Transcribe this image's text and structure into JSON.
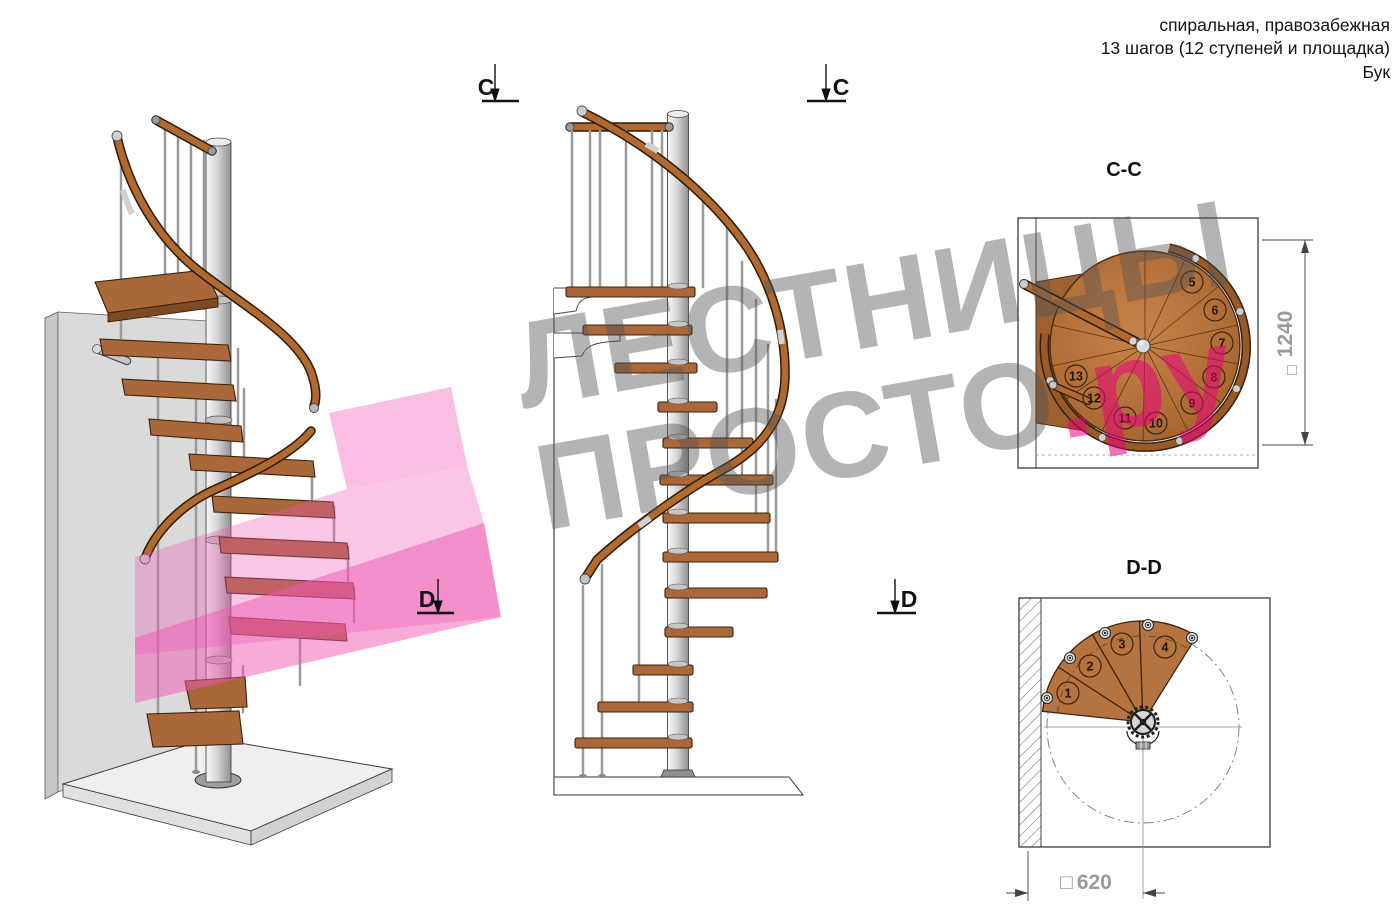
{
  "page": {
    "background": "#ffffff",
    "width": 1400,
    "height": 922
  },
  "header": {
    "line1": "спиральная, правозабежная",
    "line2": "13 шагов (12 ступеней и площадка)",
    "line3": "Бук"
  },
  "watermark": {
    "line1": "ЛЕСТНИЦЫ",
    "line2_gray": "ПРОСТО",
    "line2_pink": ".ру",
    "gray_color": "#7a7a7a",
    "pink_color": "#e6007a"
  },
  "section_markers": {
    "c_label": "C",
    "d_label": "D"
  },
  "cc_view": {
    "title": "C-C",
    "square_symbol": "□",
    "dimension_value": "1240",
    "step_labels": [
      "5",
      "6",
      "7",
      "8",
      "9",
      "10",
      "11",
      "12",
      "13"
    ]
  },
  "dd_view": {
    "title": "D-D",
    "square_symbol": "□",
    "dimension_value": "620",
    "step_labels": [
      "1",
      "2",
      "3",
      "4"
    ]
  },
  "colors": {
    "wood_tread": "#a9673a",
    "wood_dark_edge": "#3a2208",
    "handrail": "#b0692f",
    "steel_pole": "#c9c9c9",
    "wall_gray": "#dadada",
    "floor_gray": "#efefef",
    "pink_overlay": "#f057b4",
    "dimension_text_gray": "#9a9a9a",
    "watermark_gray": "#9c9c9c",
    "watermark_pink": "#f06fa8"
  }
}
